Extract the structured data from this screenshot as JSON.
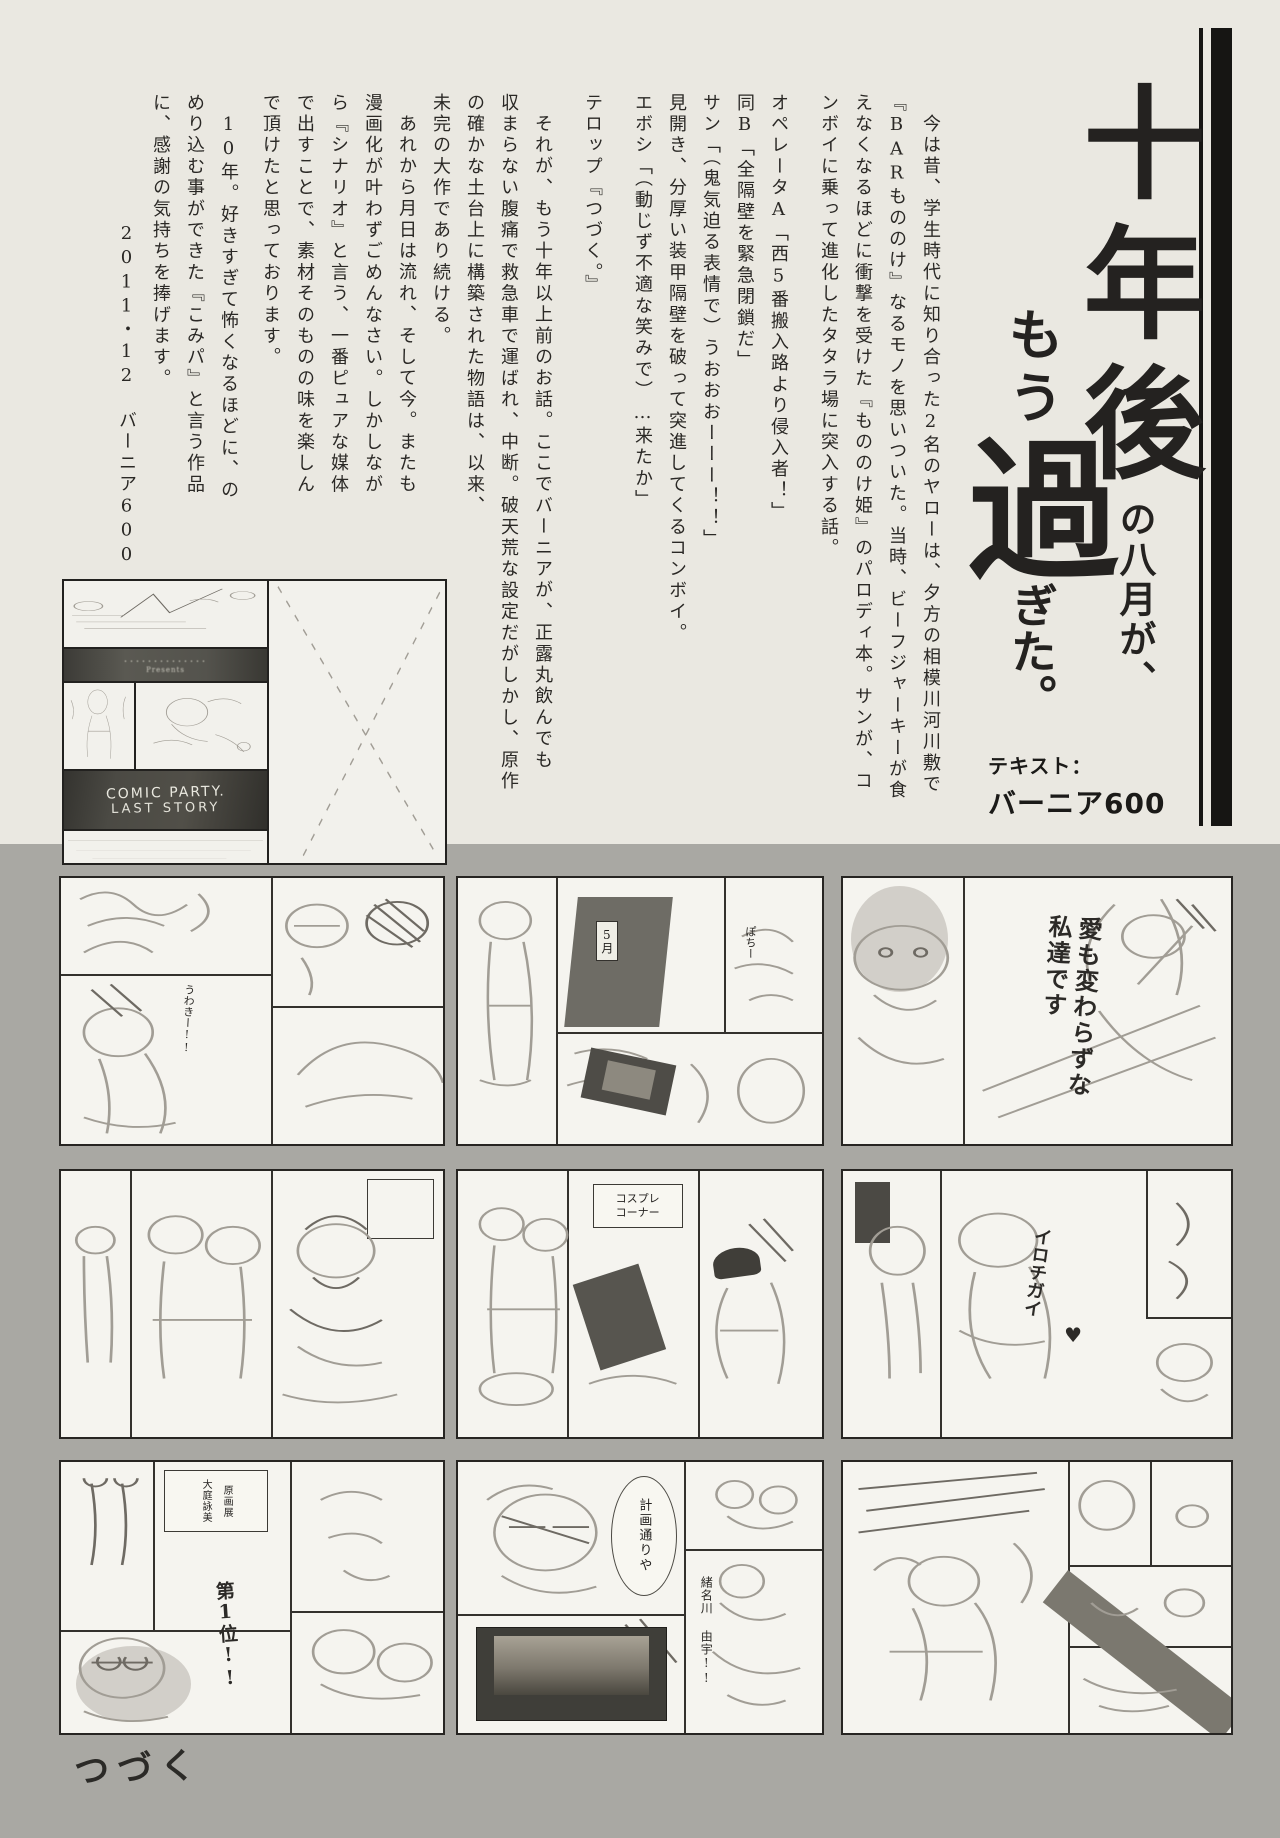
{
  "title": {
    "line1_big": "十年後",
    "line1_small": "の八月が、",
    "line2_small1": "もう",
    "line2_big": "過",
    "line2_small2": "ぎた。",
    "credit_label": "テキスト：",
    "credit_name": "バーニア600"
  },
  "body": {
    "columns": [
      "今は昔、学生時代に知り合った2名のヤローは、夕方の相模川河川敷で",
      "『BARもののけ』なるモノを思いついた。当時、ビーフジャーキーが食",
      "えなくなるほどに衝撃を受けた『もののけ姫』のパロディ本。サンが、コ",
      "ンボイに乗って進化したタタラ場に突入する話。",
      "オペレータA「西5番搬入路より侵入者！」",
      "同B「全隔壁を緊急閉鎖だ」",
      "サン「（鬼気迫る表情で）うおおおーーー！！」",
      "見開き、分厚い装甲隔壁を破って突進してくるコンボイ。",
      "エボシ「（動じず不適な笑みで）…来たか」",
      "テロップ『つづく。』",
      "それが、もう十年以上前のお話。ここでバーニアが、正露丸飲んでも",
      "収まらない腹痛で救急車で運ばれ、中断。破天荒な設定だがしかし、原作",
      "の確かな土台上に構築された物語は、以来、",
      "未完の大作であり続ける。",
      "あれから月日は流れ、そして今。またも",
      "漫画化が叶わずごめんなさい。しかしなが",
      "ら『シナリオ』と言う、一番ピュアな媒体",
      "で出すことで、素材そのものの味を楽しん",
      "で頂けたと思っております。",
      "10年。好きすぎて怖くなるほどに、の",
      "めり込む事ができた『こみパ』と言う作品",
      "に、感謝の気持ちを捧げます。",
      "2011・12　バーニア600"
    ]
  },
  "miniboard": {
    "band1_line1": "･･････････････",
    "band1_line2": "Presents",
    "band2_line1": "COMIC PARTY.",
    "band2_line2": "LAST STORY"
  },
  "panels": {
    "p1_note": "うわきー!!",
    "p2_door_label": "5月",
    "p2_note": "ぽちー",
    "p3_caption": "愛も変わらずな私達です",
    "p5_sign_line1": "コスプレ",
    "p5_sign_line2": "コーナー",
    "p6_caption": "イロチガイ",
    "p6_heart": "♥",
    "p7_sign_col1": "大庭詠美",
    "p7_sign_col2": "原画展",
    "p7_rank": "第1位!!",
    "p8_bubble": "計画通りや",
    "p8_name": "緒名川 由宇!!"
  },
  "footer": {
    "tsuzuku": "つづく"
  },
  "colors": {
    "paper": "#eae8e1",
    "gray_band": "#a9a8a3",
    "ink": "#161513"
  }
}
